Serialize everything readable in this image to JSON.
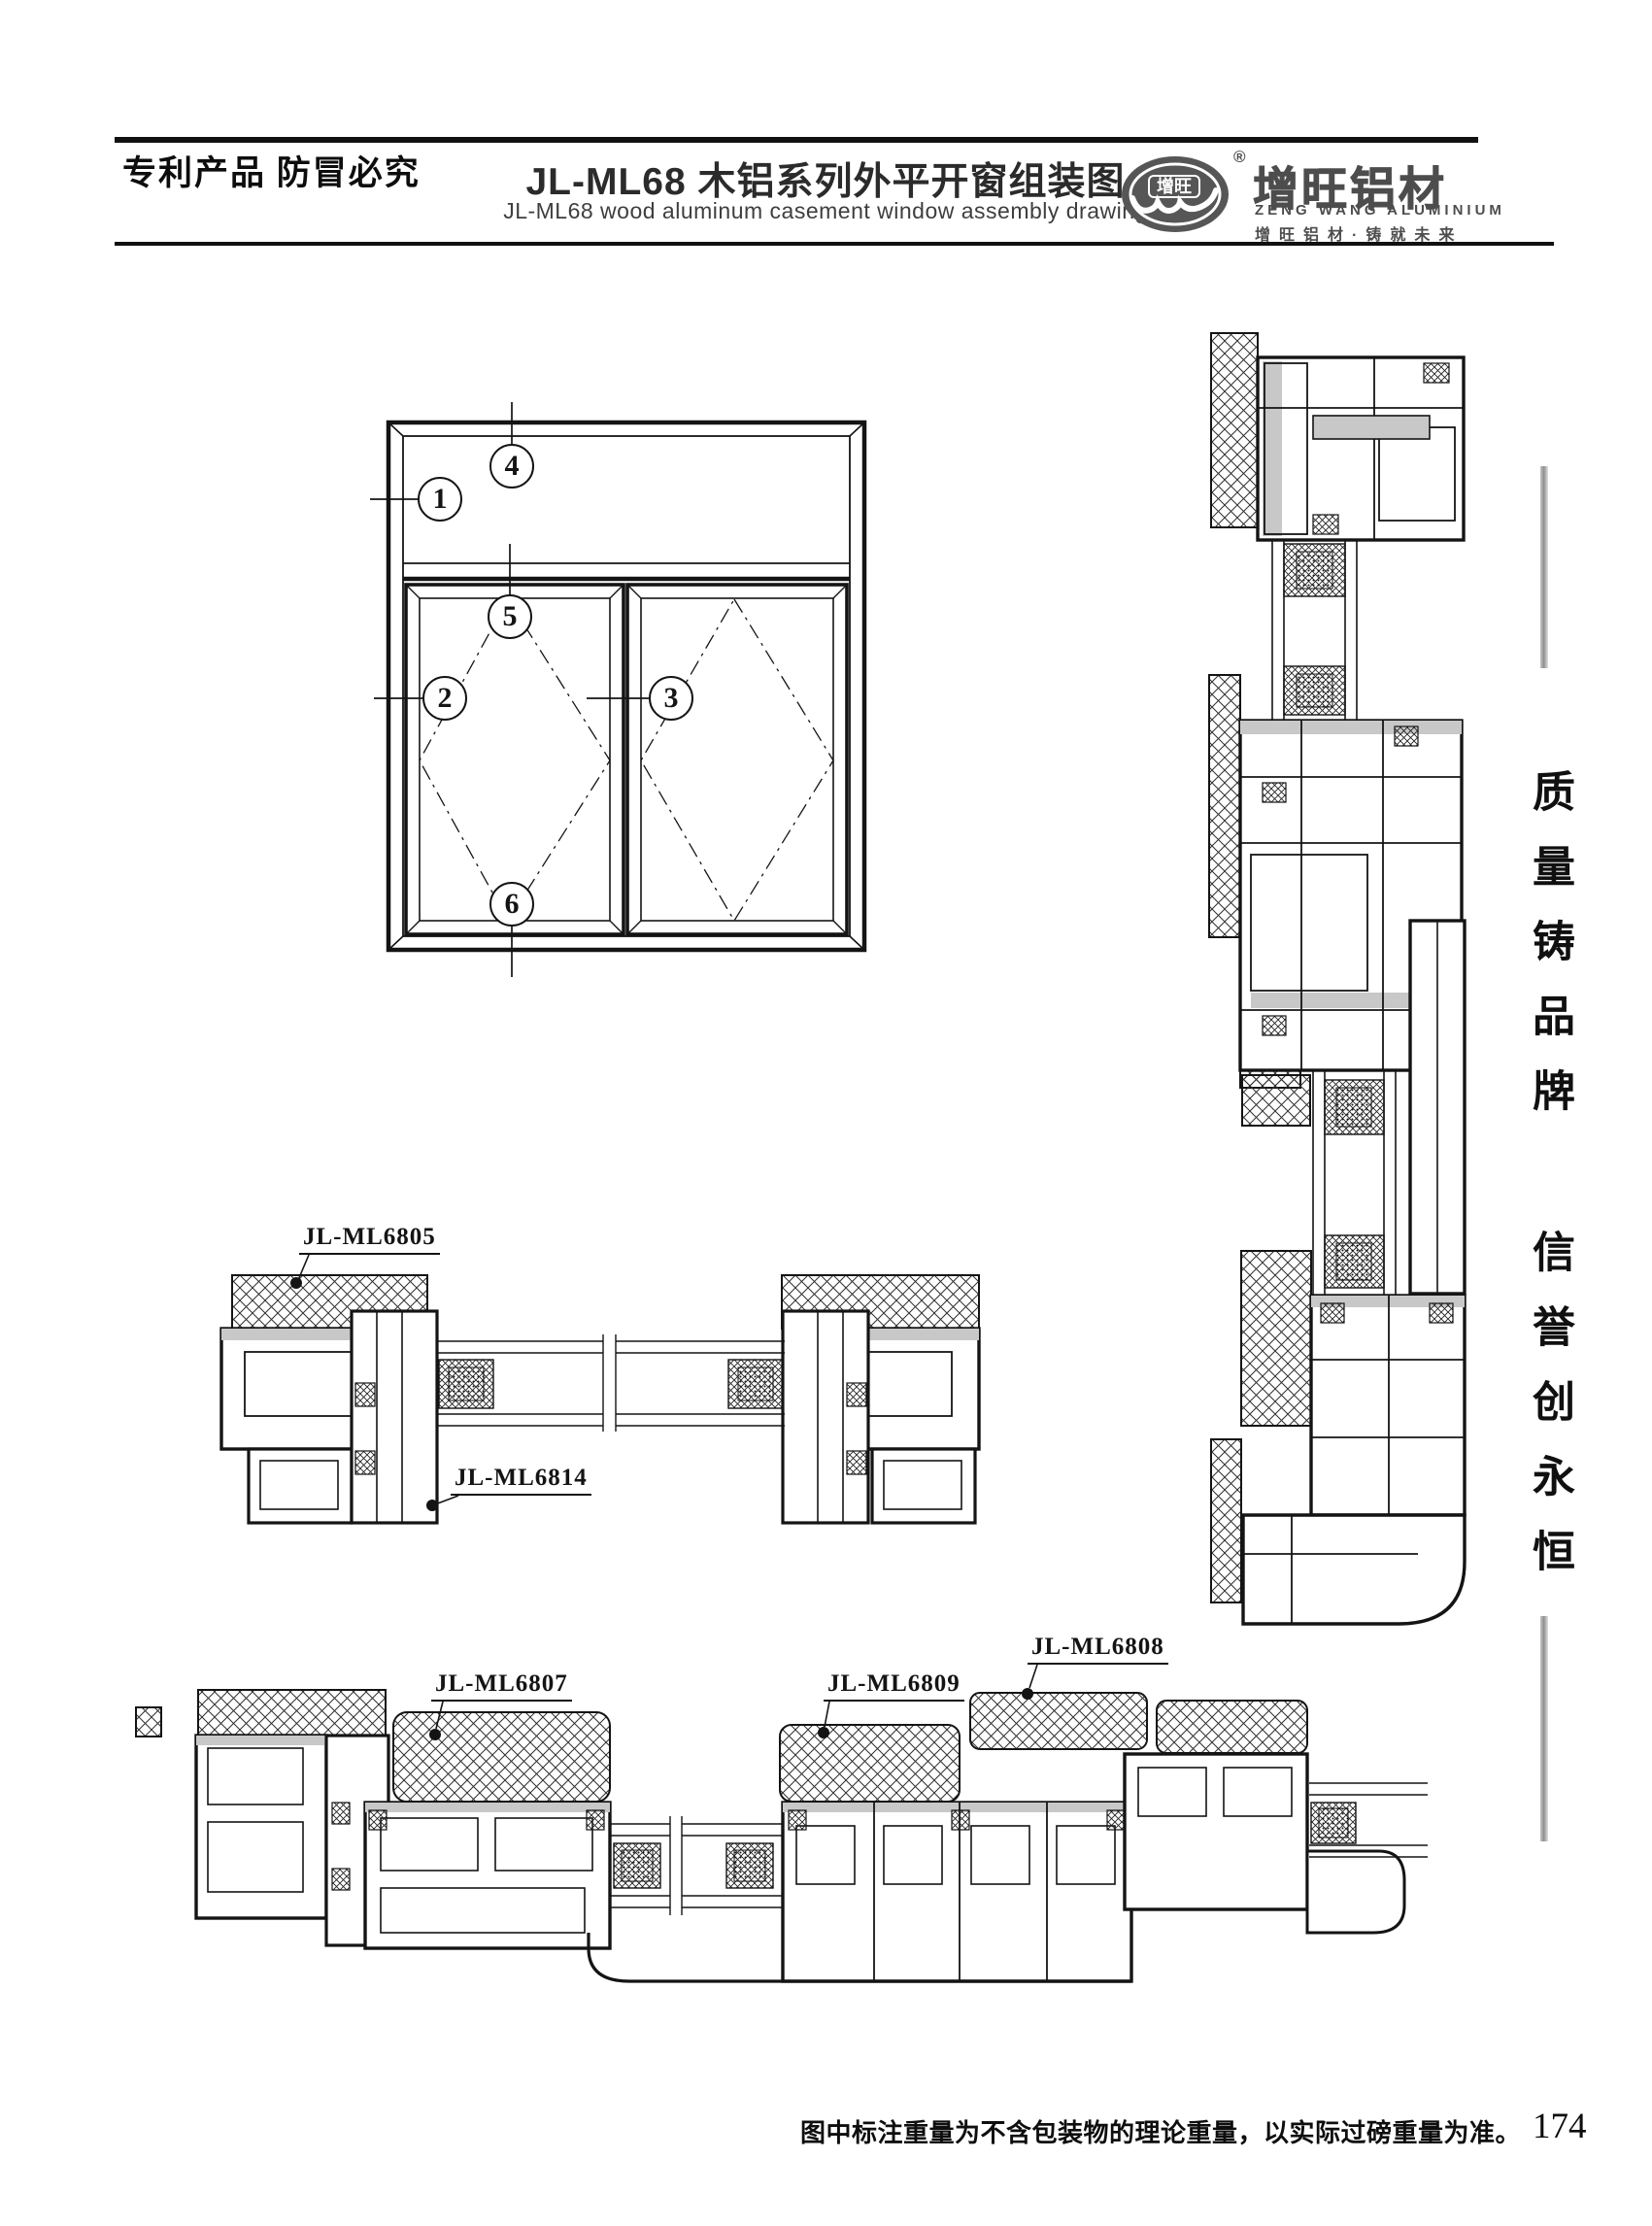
{
  "header": {
    "patent_notice": "专利产品 防冒必究",
    "title_cn": "JL-ML68 木铝系列外平开窗组装图",
    "title_en": "JL-ML68 wood aluminum casement window assembly drawing",
    "logo": {
      "oval_text": "增旺",
      "registered": "®",
      "brand_cn": "增旺铝材",
      "brand_en": "ZENG WANG ALUMINIUM",
      "slogan": "增旺铝材·铸就未来"
    }
  },
  "elevation": {
    "callouts": [
      {
        "num": "1"
      },
      {
        "num": "2"
      },
      {
        "num": "3"
      },
      {
        "num": "4"
      },
      {
        "num": "5"
      },
      {
        "num": "6"
      }
    ]
  },
  "labels": {
    "ml6805": "JL-ML6805",
    "ml6814": "JL-ML6814",
    "ml6807": "JL-ML6807",
    "ml6809": "JL-ML6809",
    "ml6808": "JL-ML6808"
  },
  "sidebar": {
    "slogan_top": "质量铸品牌",
    "slogan_bottom": "信誉创永恒"
  },
  "footer": {
    "note": "图中标注重量为不含包装物的理论重量，以实际过磅重量为准。",
    "page_number": "174"
  }
}
